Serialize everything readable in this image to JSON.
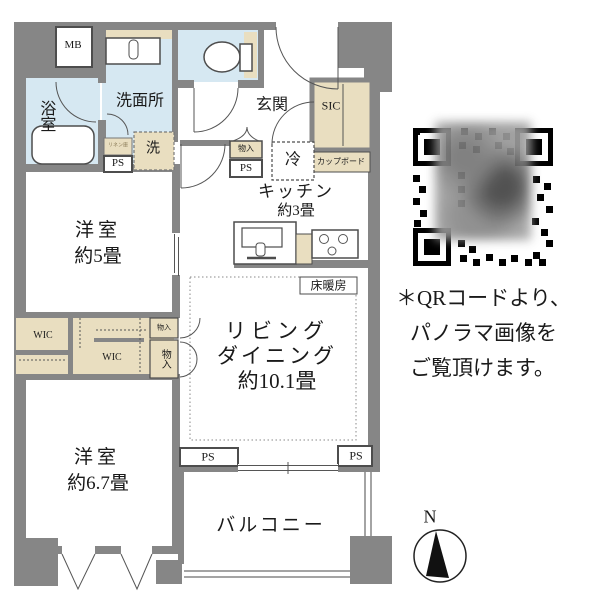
{
  "floorplan": {
    "labels": {
      "mb": "MB",
      "bath": "浴室",
      "washroom": "洗面所",
      "linen": "リネン庫",
      "laundry": "洗",
      "ps": "PS",
      "genkan": "玄関",
      "sic": "SIC",
      "storage": "物入",
      "fridge": "冷",
      "cupboard": "カップボード",
      "kitchen_name": "キッチン",
      "kitchen_size": "約3畳",
      "floor_heating": "床暖房",
      "living_line1": "リビング",
      "living_line2": "ダイニング",
      "living_size": "約10.1畳",
      "bedroom1_name": "洋室",
      "bedroom1_size": "約5畳",
      "bedroom2_name": "洋室",
      "bedroom2_size": "約6.7畳",
      "wic": "WIC",
      "balcony": "バルコニー"
    }
  },
  "qr_note": {
    "line1": "＊QRコードより、",
    "line2": "パノラマ画像を",
    "line3": "ご覧頂けます。"
  },
  "compass": {
    "north": "N"
  },
  "colors": {
    "wall": "#868686",
    "wet_area": "#d6e8f2",
    "closet_beige": "#e9dec0",
    "outline": "#4d4d4d"
  }
}
